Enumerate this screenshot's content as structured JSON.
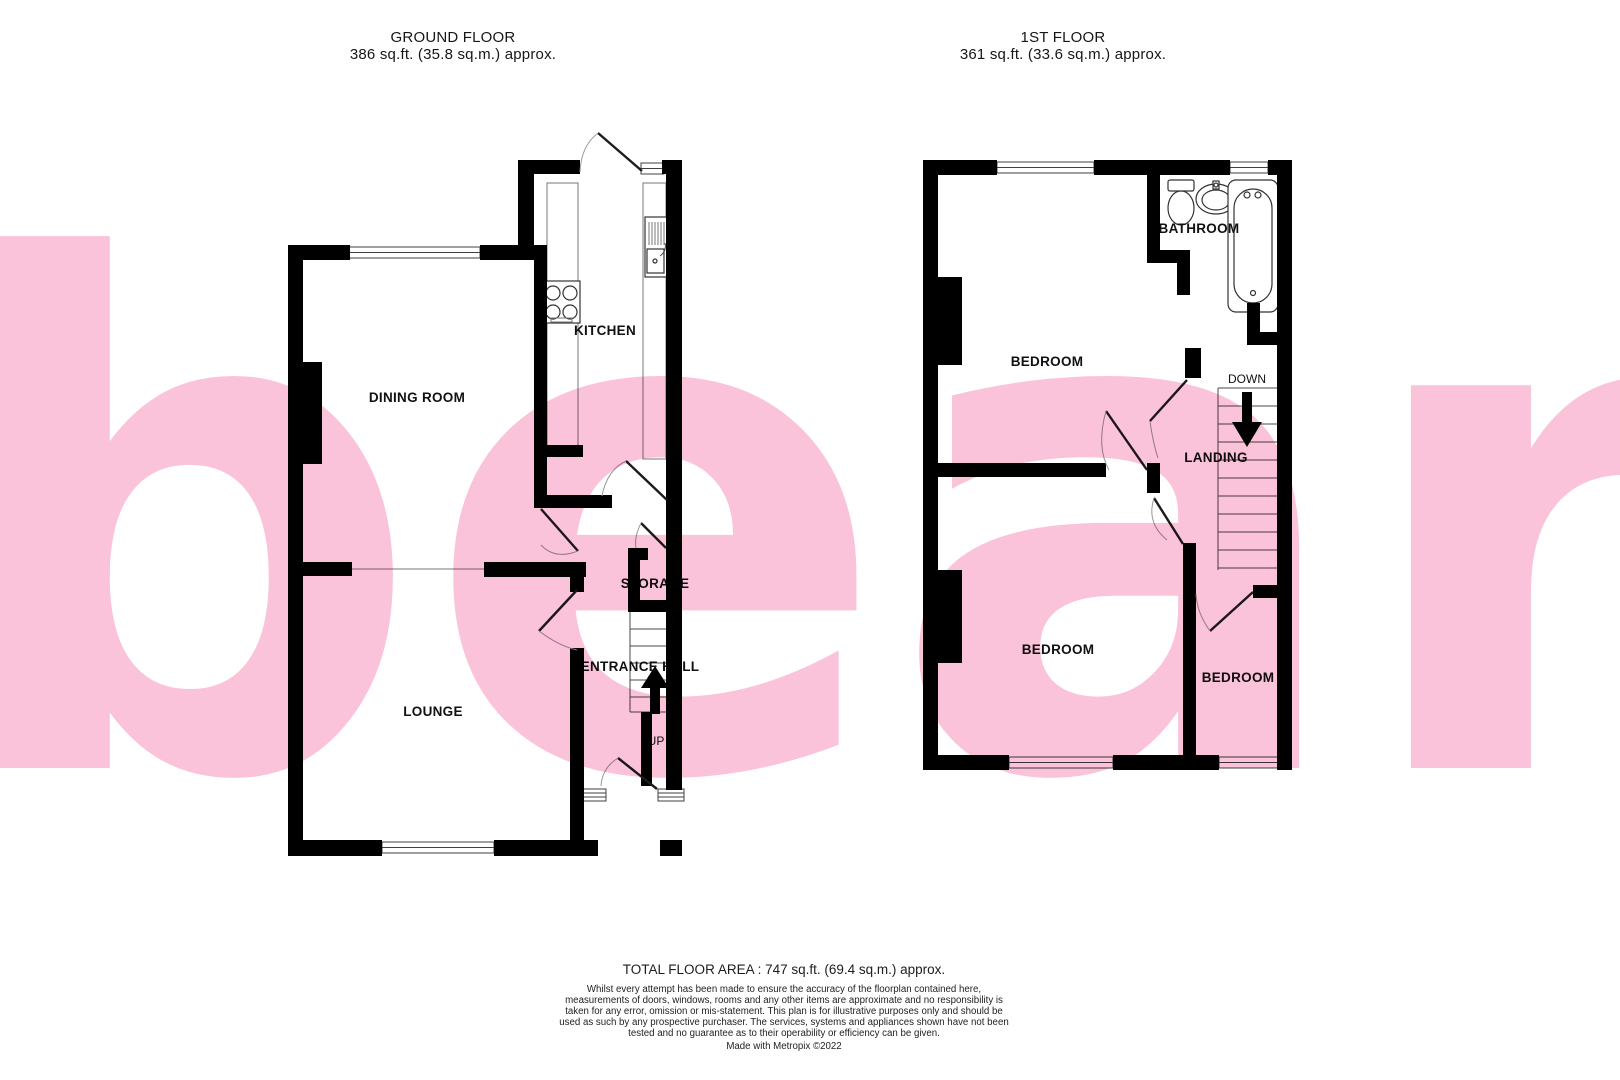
{
  "watermark": {
    "text": "bear",
    "color": "#fac3d9"
  },
  "colors": {
    "wall": "#000000",
    "watermark_pink": "#fac3d9",
    "thin_line": "#4a4a4a"
  },
  "ground_floor": {
    "title": "GROUND FLOOR",
    "area": "386 sq.ft. (35.8 sq.m.) approx.",
    "rooms": {
      "kitchen": "KITCHEN",
      "dining": "DINING ROOM",
      "lounge": "LOUNGE",
      "storage": "STORAGE",
      "hall": "ENTRANCE HALL",
      "up": "UP"
    }
  },
  "first_floor": {
    "title": "1ST FLOOR",
    "area": "361 sq.ft. (33.6 sq.m.) approx.",
    "rooms": {
      "bathroom": "BATHROOM",
      "bedroom1": "BEDROOM",
      "bedroom2": "BEDROOM",
      "bedroom3": "BEDROOM",
      "landing": "LANDING",
      "down": "DOWN"
    }
  },
  "footer": {
    "total": "TOTAL FLOOR AREA : 747 sq.ft. (69.4 sq.m.) approx.",
    "disclaimer": "Whilst every attempt has been made to ensure the accuracy of the floorplan contained here, measurements of doors, windows, rooms and any other items are approximate and no responsibility is taken for any error, omission or mis-statement. This plan is for illustrative purposes only and should be used as such by any prospective purchaser. The services, systems and appliances shown have not been tested and no guarantee as to their operability or efficiency can be given.",
    "credit": "Made with Metropix ©2022"
  }
}
